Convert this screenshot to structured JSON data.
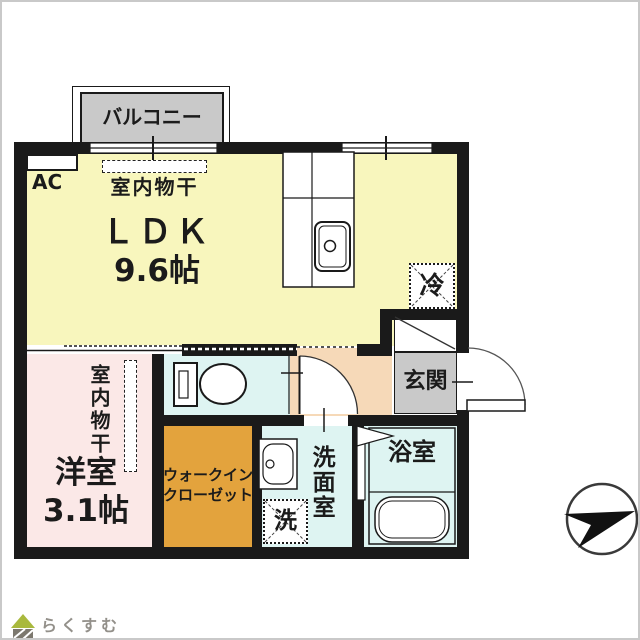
{
  "colors": {
    "wall": "#1a1a1a",
    "ldk_yellow": "#f8f6bd",
    "western_pink": "#fbe8e7",
    "hall_peach": "#f6d9b8",
    "closet_orange": "#e3a33d",
    "wet_area_cyan": "#def4f2",
    "gray_area": "#c9c9c9",
    "logo_green": "#a9b93d",
    "logo_gray": "#7c786e"
  },
  "rooms": {
    "balcony": {
      "label": "バルコニー"
    },
    "ldk": {
      "name": "ＬＤＫ",
      "size": "9.6帖",
      "ac_label": "AC",
      "drying_label": "室内物干",
      "fridge_label": "冷"
    },
    "entrance": {
      "label": "玄関"
    },
    "western_room": {
      "name": "洋室",
      "size": "3.1帖",
      "drying_label": "室内物干"
    },
    "walk_in_closet": {
      "label_line1": "ウォークイン",
      "label_line2": "クローゼット"
    },
    "washroom": {
      "label": "洗面室",
      "washer_label": "洗"
    },
    "bathroom": {
      "label": "浴室"
    }
  },
  "footer": {
    "brand": "らくすむ"
  }
}
